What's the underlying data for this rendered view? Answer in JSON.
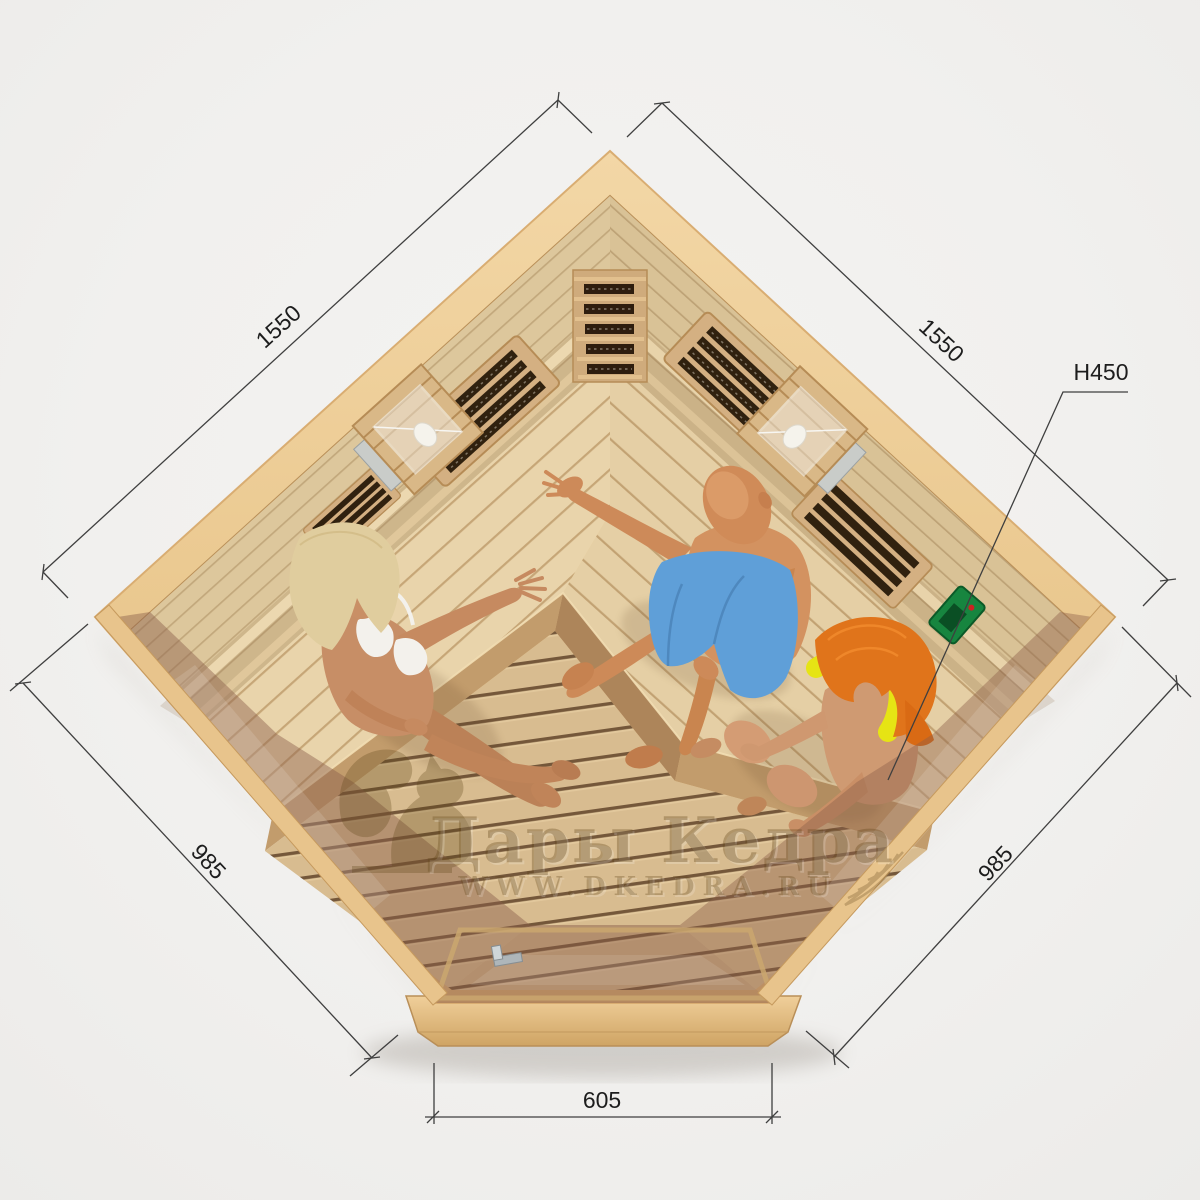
{
  "scene": {
    "description": "Top view 3D render of a pentagonal corner infrared sauna with three people inside",
    "background_color": "#f1f0ee"
  },
  "watermark": {
    "title": "Дары Кедра",
    "url": "WWW.DKEDRA.RU",
    "color": "#5f4418"
  },
  "dimensions": {
    "left_wall": "1550",
    "right_wall": "1550",
    "front_left": "985",
    "front_right": "985",
    "door_front": "605",
    "bench_height": "H450"
  },
  "colors": {
    "frame_wood": "#eac88f",
    "wall_wood": "#ddc79c",
    "bench_wood": "#e9d4ab",
    "floor_wood": "#d8bc90",
    "glass_tint": "#8c5f4b",
    "control_panel_green": "#17853f",
    "dimension_line": "#3f3f3f"
  },
  "objects": {
    "heaters": [
      "corner-heater",
      "left-wall-heater-upper",
      "left-wall-heater-lower",
      "right-wall-heater-upper",
      "right-wall-heater-lower"
    ],
    "lamps": [
      "wall-lamp-left",
      "wall-lamp-right"
    ],
    "controls": [
      "control-panel"
    ],
    "door": [
      "glass-door",
      "door-handle"
    ]
  },
  "people": [
    {
      "id": "blonde-woman",
      "hair": "blonde",
      "swimsuit": "white"
    },
    {
      "id": "man",
      "hair": "bald",
      "swimsuit": "blue"
    },
    {
      "id": "red-haired-woman",
      "hair": "red",
      "swimsuit": "yellow"
    }
  ]
}
